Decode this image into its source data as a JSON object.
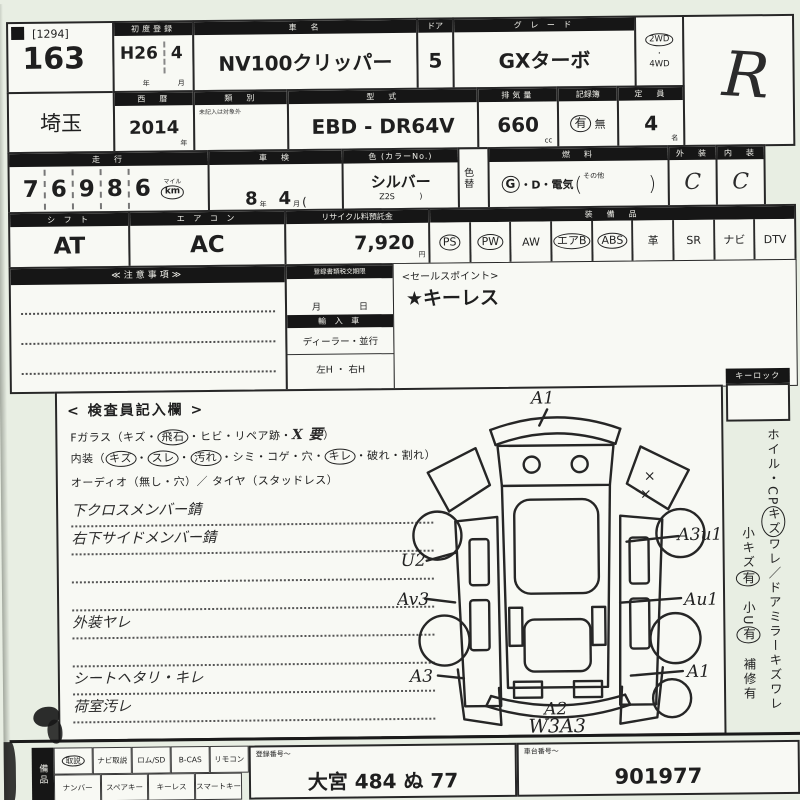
{
  "sheet": {
    "r1": {
      "lot_bracket": "[1294]",
      "lot": "163",
      "firstreg_label": "初度登録",
      "firstreg_era": "H26",
      "firstreg_month": "4",
      "unit_year": "年",
      "unit_month": "月",
      "name_label": "車　名",
      "name": "NV100クリッパー",
      "door_label": "ドア",
      "door": "5",
      "grade_label": "グ レ ー ド",
      "grade": "GXターボ",
      "wd2": "2WD",
      "wd4": "4WD",
      "hand_grade": "R"
    },
    "r2": {
      "pref": "埼玉",
      "year_label": "西　暦",
      "year": "2014",
      "kata_label": "類　別",
      "kata_note": "未記入は対象外",
      "model_label": "型　式",
      "model": "EBD - DR64V",
      "disp_label": "排気量",
      "disp": "660",
      "disp_unit": "cc",
      "record_label": "記録簿",
      "record_yes": "有",
      "record_no": "無",
      "cap_label": "定　員",
      "cap": "4",
      "cap_unit": "名"
    },
    "r3": {
      "mileage_label": "走　行",
      "digits": [
        "7",
        "6",
        "9",
        "8",
        "6"
      ],
      "mile_unit": "マイル",
      "km_unit": "km",
      "shaken_label": "車　検",
      "shaken_year": "8",
      "shaken_month": "4",
      "shaken_paren": "(",
      "color_label": "色 (カラーNo.)",
      "color": "シルバー",
      "color_code": "Z2S",
      "color_paren": ")",
      "colorchange_label": "色替",
      "fuel_label": "燃　料",
      "fuel_g": "G",
      "fuel_rest": "・D・電気",
      "fuel_open": "(",
      "fuel_other": "その他",
      "fuel_close": ")",
      "ext_label": "外　装",
      "ext_grade": "C",
      "int_label": "内　装",
      "int_grade": "C"
    },
    "r4": {
      "shift_label": "シ フ ト",
      "shift": "AT",
      "ac_label": "エ ア コ ン",
      "ac": "AC",
      "recycle_label": "リサイクル料預託金",
      "recycle": "7,920",
      "recycle_unit": "円",
      "equip_label": "装　備　品",
      "equip": [
        {
          "t": "PS",
          "c": true
        },
        {
          "t": "PW",
          "c": true
        },
        {
          "t": "AW"
        },
        {
          "t": "エアB",
          "c": true
        },
        {
          "t": "ABS",
          "c": true
        },
        {
          "t": "革"
        },
        {
          "t": "SR"
        },
        {
          "t": "ナビ"
        },
        {
          "t": "DTV"
        }
      ]
    },
    "mid": {
      "notes_label": "≪注意事項≫",
      "docs_label": "登録書類税交期限",
      "month_unit": "月",
      "day_unit": "日",
      "import_label": "輸 入 車",
      "import_opts": "ディーラー・並行",
      "handle_opts": "左H ・ 右H",
      "sales_label": "<セールスポイント>",
      "sales_value": "★キーレス"
    },
    "insp": {
      "title": "< 検査員記入欄 >",
      "glass_tokens": [
        {
          "t": "Fガラス（キズ・"
        },
        {
          "t": "飛石",
          "c": true
        },
        {
          "t": "・ヒビ・リペア跡・"
        },
        {
          "t": "X 要",
          "hand": true
        },
        {
          "t": "）"
        }
      ],
      "interior_tokens": [
        {
          "t": "内装（"
        },
        {
          "t": "キズ",
          "c": true
        },
        {
          "t": "・"
        },
        {
          "t": "スレ",
          "c": true
        },
        {
          "t": "・"
        },
        {
          "t": "汚れ",
          "c": true
        },
        {
          "t": "・シミ・コゲ・穴・"
        },
        {
          "t": "キレ",
          "c": true
        },
        {
          "t": "・破れ・割れ）"
        }
      ],
      "audio_line": "オーディオ（無し・穴）／ タイヤ（スタッドレス）",
      "hand_notes": [
        {
          "t": "下クロスメンバー錆"
        },
        {
          "t": "右下サイドメンバー錆"
        },
        {
          "t": ""
        },
        {
          "t": ""
        },
        {
          "t": "外装ヤレ"
        },
        {
          "t": ""
        },
        {
          "t": "シートヘタリ・キレ"
        },
        {
          "t": "荷室汚レ"
        },
        {
          "t": ""
        }
      ]
    },
    "diagram": {
      "top": "A1",
      "mark1": "×",
      "mark2": "×",
      "right1": "A3u1",
      "right2": "Au1",
      "right3": "A1",
      "left1": "U2",
      "left2": "Av3",
      "left3": "A3",
      "bumper": "A2",
      "bottom": "W3A3"
    },
    "side": {
      "keylock_label": "キーロック",
      "line1_tokens": [
        {
          "t": "ホイル・CP"
        },
        {
          "t": "キズ",
          "c": true
        },
        {
          "t": "ワレ／ドアミラーキズワレ"
        }
      ],
      "line2_tokens": [
        {
          "t": "小キズ"
        },
        {
          "t": "有",
          "c": true
        },
        {
          "t": "　小U"
        },
        {
          "t": "有",
          "c": true
        },
        {
          "t": "　補修有"
        }
      ]
    },
    "bottom": {
      "tab_label": "備品",
      "row1": [
        {
          "t": "取説",
          "c": true
        },
        {
          "t": "ナビ取説"
        },
        {
          "t": "ロム/SD"
        },
        {
          "t": "B-CAS"
        },
        {
          "t": "リモコン"
        }
      ],
      "row2": [
        {
          "t": "ナンバー"
        },
        {
          "t": "スペアキー"
        },
        {
          "t": "キーレス"
        },
        {
          "t": "スマートキー"
        }
      ],
      "reg_label": "登録番号〜",
      "reg_value": "大宮 484 ぬ 77",
      "chassis_label": "車台番号〜",
      "chassis_value": "901977"
    }
  }
}
